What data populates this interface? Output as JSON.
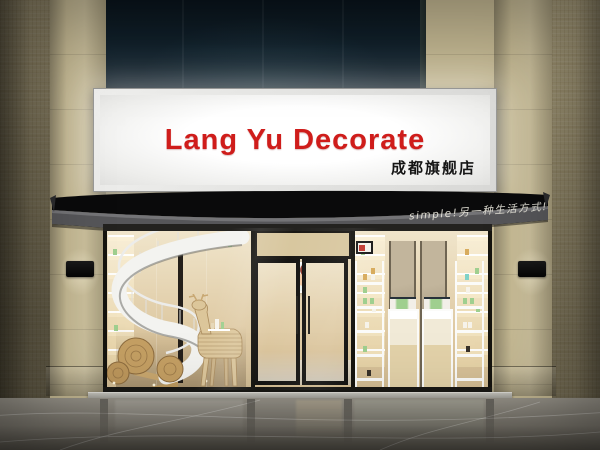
{
  "scene": {
    "signboard": {
      "title": "Lang Yu Decorate",
      "subtitle": "成都旗舰店",
      "title_color": "#cf1d1b",
      "subtitle_color": "#161616",
      "lightbox_color": "#f5f4f1",
      "frame_color": "#dededc"
    },
    "awning": {
      "slogan": "simple!另一种生活方式!",
      "slogan_color": "#e8e6de",
      "canopy_color": "#0a0a0b",
      "fascia_color": "#57575a"
    },
    "facade": {
      "tile_color": "#c6ba94",
      "upper_glass_color": "#101f2a",
      "storefront_frame_color": "#1d1c19",
      "wall_lamp_color": "#0c0c0c"
    },
    "interior": {
      "wood_color": "#e3d0a7",
      "product_green": "#9fcf8f",
      "staircase_color": "#f3f3f0"
    },
    "ground": {
      "floor_color": "#86827a",
      "step_color": "#b7b6af"
    }
  }
}
